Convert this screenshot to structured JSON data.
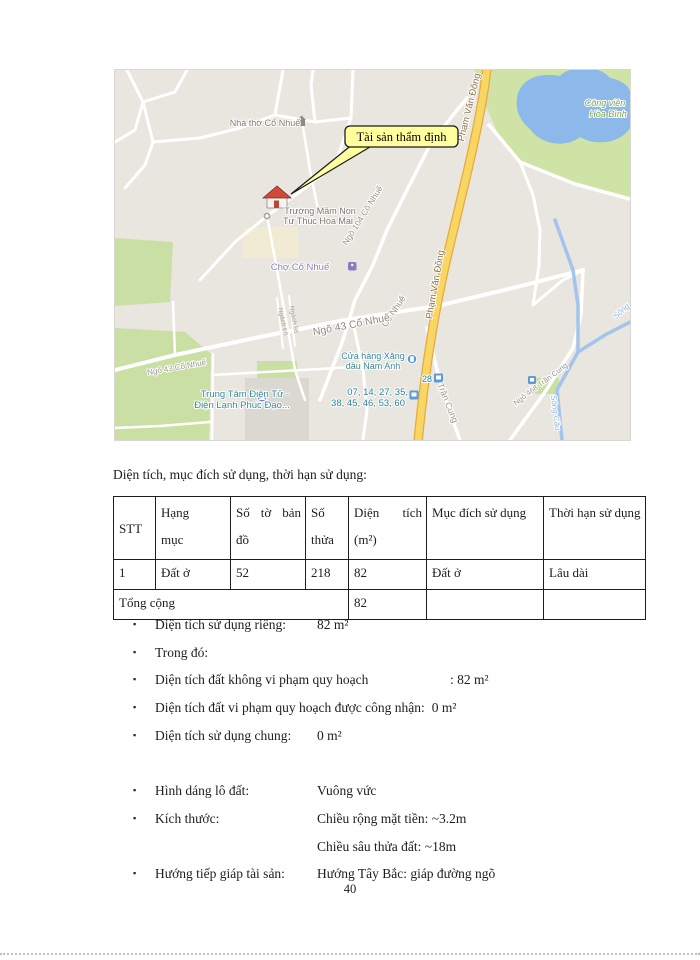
{
  "map": {
    "callout": "Tài sản thẩm định",
    "labels": {
      "church": "Nhà thờ Cổ Nhuế",
      "school_line1": "Trường Mầm Non",
      "school_line2": "Tư Thục Hoa Mai",
      "market": "Chợ Cổ Nhuế",
      "park_line1": "Công viên",
      "park_line2": "Hòa Bình",
      "road_pvd": "Phạm Văn Đồng",
      "road_ngo104": "Ngõ 104 Cổ Nhuế",
      "road_conhue": "Cổ Nhuế",
      "road_ngo43": "Ngõ 43 Cổ Nhuế",
      "road_ngo43_small": "Ngõ 43 Cổ Nhuế",
      "road_trancung": "Trần Cung",
      "road_ngo468": "Ngõ 468 Trần Cung",
      "alley1": "Ngách 66",
      "alley2": "Ngách 96",
      "river": "Sông Cầu",
      "river2": "Sông",
      "gas_line1": "Cửa hàng Xăng",
      "gas_line2": "dầu Nam Anh",
      "electronics_line1": "Trung Tâm Điện Tử -",
      "electronics_line2": "Điện Lạnh Phúc Đạo...",
      "bus_stop_28": "28",
      "bus_lines_1": "07, 14, 27, 35,",
      "bus_lines_2": "38, 45, 46, 53, 60"
    },
    "colors": {
      "park_green": "#cfe3a6",
      "water_blue": "#8db9ea",
      "main_road_yellow": "#f8d664",
      "callout_yellow": "#ffff9e"
    }
  },
  "section": {
    "intro": "Diện tích, mục đích sử dụng, thời hạn sử dụng:"
  },
  "table": {
    "headers": [
      "STT",
      "Hạng mục",
      "Số tờ bản đồ",
      "Số thửa",
      "Diện tích (m²)",
      "Mục đích sử dụng",
      "Thời hạn sử dụng"
    ],
    "rows": [
      [
        "1",
        "Đất ở",
        "52",
        "218",
        "82",
        "Đất ở",
        "Lâu dài"
      ]
    ],
    "footer": {
      "label": "Tổng cộng",
      "area": "82"
    }
  },
  "bullets": [
    {
      "label": "Diện tích sử dụng riêng:",
      "value": "82 m²"
    },
    {
      "label": "Trong đó:",
      "value": ""
    },
    {
      "label": "Diện tích đất không vi phạm quy hoạch",
      "value": ": 82 m²"
    },
    {
      "label": "Diện tích đất vi phạm quy hoạch được công nhận:",
      "value": "0 m²"
    },
    {
      "label": "Diện tích sử dụng chung:",
      "value": "0 m²"
    },
    {
      "label": "Hình dáng lô đất:",
      "value": "Vuông vức"
    },
    {
      "label": "Kích thước:",
      "value": "Chiều rộng mặt tiền: ~3.2m",
      "value2": "Chiều sâu thửa đất: ~18m"
    },
    {
      "label": "Hướng tiếp giáp tài sản:",
      "value": "Hướng Tây Bắc: giáp đường ngõ"
    }
  ],
  "page": {
    "number": "40"
  }
}
